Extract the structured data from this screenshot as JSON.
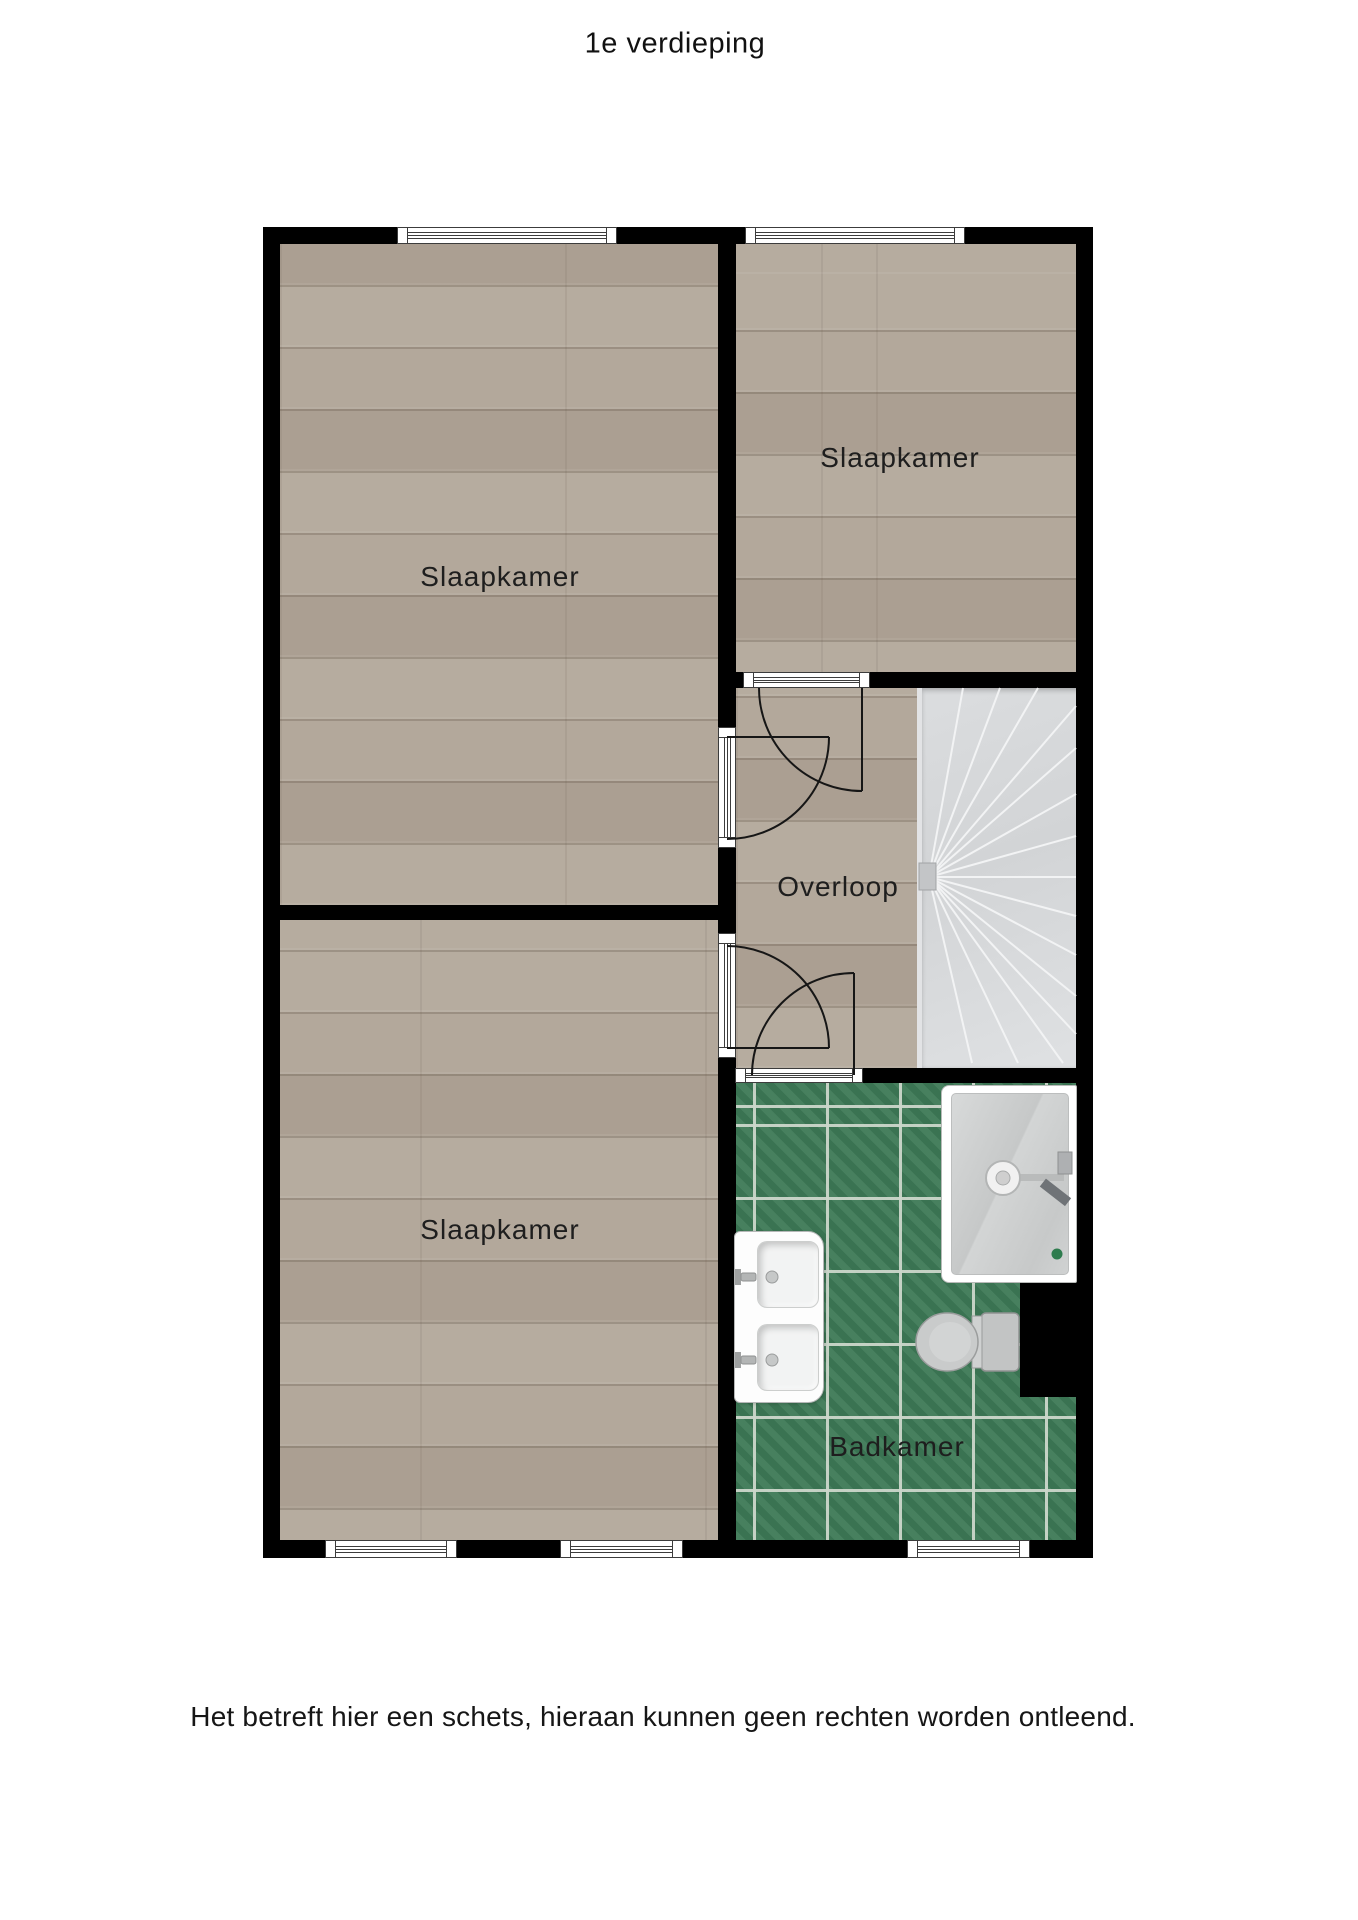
{
  "page": {
    "title": "1e verdieping",
    "disclaimer": "Het betreft hier een schets, hieraan kunnen geen rechten worden ontleend."
  },
  "rooms": {
    "bedroom_top_left": {
      "label": "Slaapkamer"
    },
    "bedroom_top_right": {
      "label": "Slaapkamer"
    },
    "bedroom_bottom_left": {
      "label": "Slaapkamer"
    },
    "landing": {
      "label": "Overloop"
    },
    "bathroom": {
      "label": "Badkamer"
    }
  },
  "fixtures": {
    "stairs": "winder-stairs",
    "shower": "shower-cabin",
    "sink": "double-washbasin",
    "toilet": "toilet",
    "shaft": "duct-shaft",
    "windows": 5,
    "doors": 4
  },
  "colors": {
    "wall": "#000000",
    "wood_floor": "#b2a79a",
    "bathroom_tile": "#3d7956",
    "tile_grout": "#cbd6ca",
    "stairs": "#d7d9db",
    "fixture_gray": "#c9cbcb",
    "drain_green": "#2e7c4e",
    "text": "#1e1e1e"
  }
}
